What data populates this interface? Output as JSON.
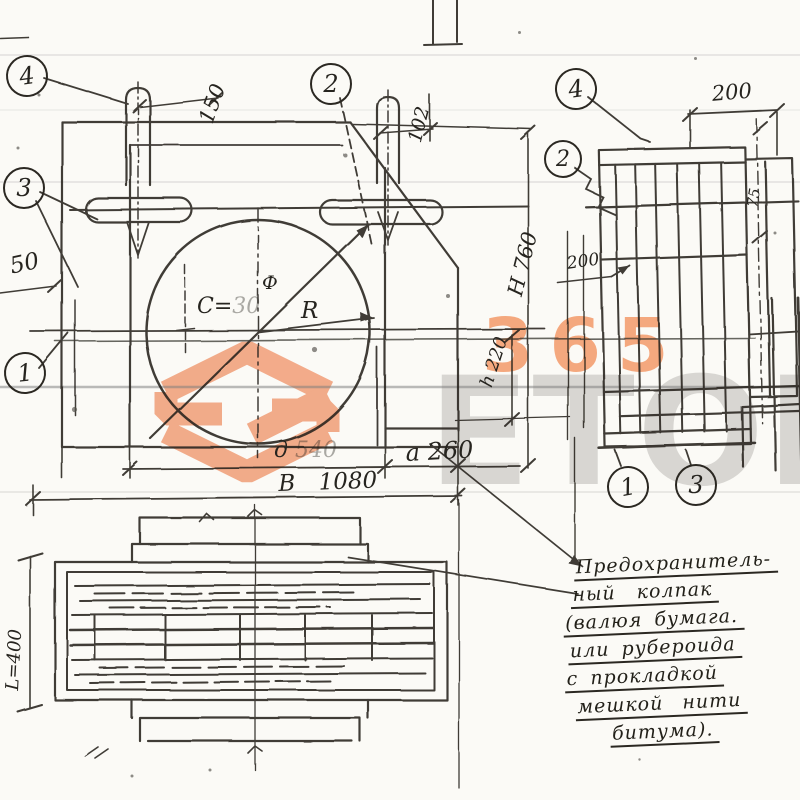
{
  "drawing": {
    "front_view": {
      "dim_150": "150",
      "dim_102": "102",
      "dim_50": "50",
      "center_label_prefix": "C=",
      "center_label_value": "30",
      "phi_label": "Ф",
      "radius_label": "R",
      "dim_d": "д",
      "dim_d_value": "540",
      "dim_a": "a 260",
      "dim_b": "B 1080",
      "dim_H": "H 760",
      "dim_h": "h 220"
    },
    "side_view": {
      "dim_top": "200",
      "dim_left": "200",
      "dim_right": "75"
    },
    "bottom_view": {
      "dim_length": "L=400"
    },
    "callouts": {
      "left_4": "4",
      "left_3": "3",
      "left_1": "1",
      "top_2": "2",
      "right_4": "4",
      "right_2": "2",
      "bottom_1": "1",
      "bottom_3": "3"
    },
    "note": {
      "lines": [
        "Предохранитель-",
        "ный колпак",
        "(валюя бумага.",
        "или рубероида",
        "с прокладкой",
        "мешкой нити",
        "битума)."
      ]
    }
  },
  "watermark": {
    "digits": "365",
    "brand": "ETON",
    "accent_color": "#f09a72",
    "gray_color": "#a8a4a0"
  }
}
